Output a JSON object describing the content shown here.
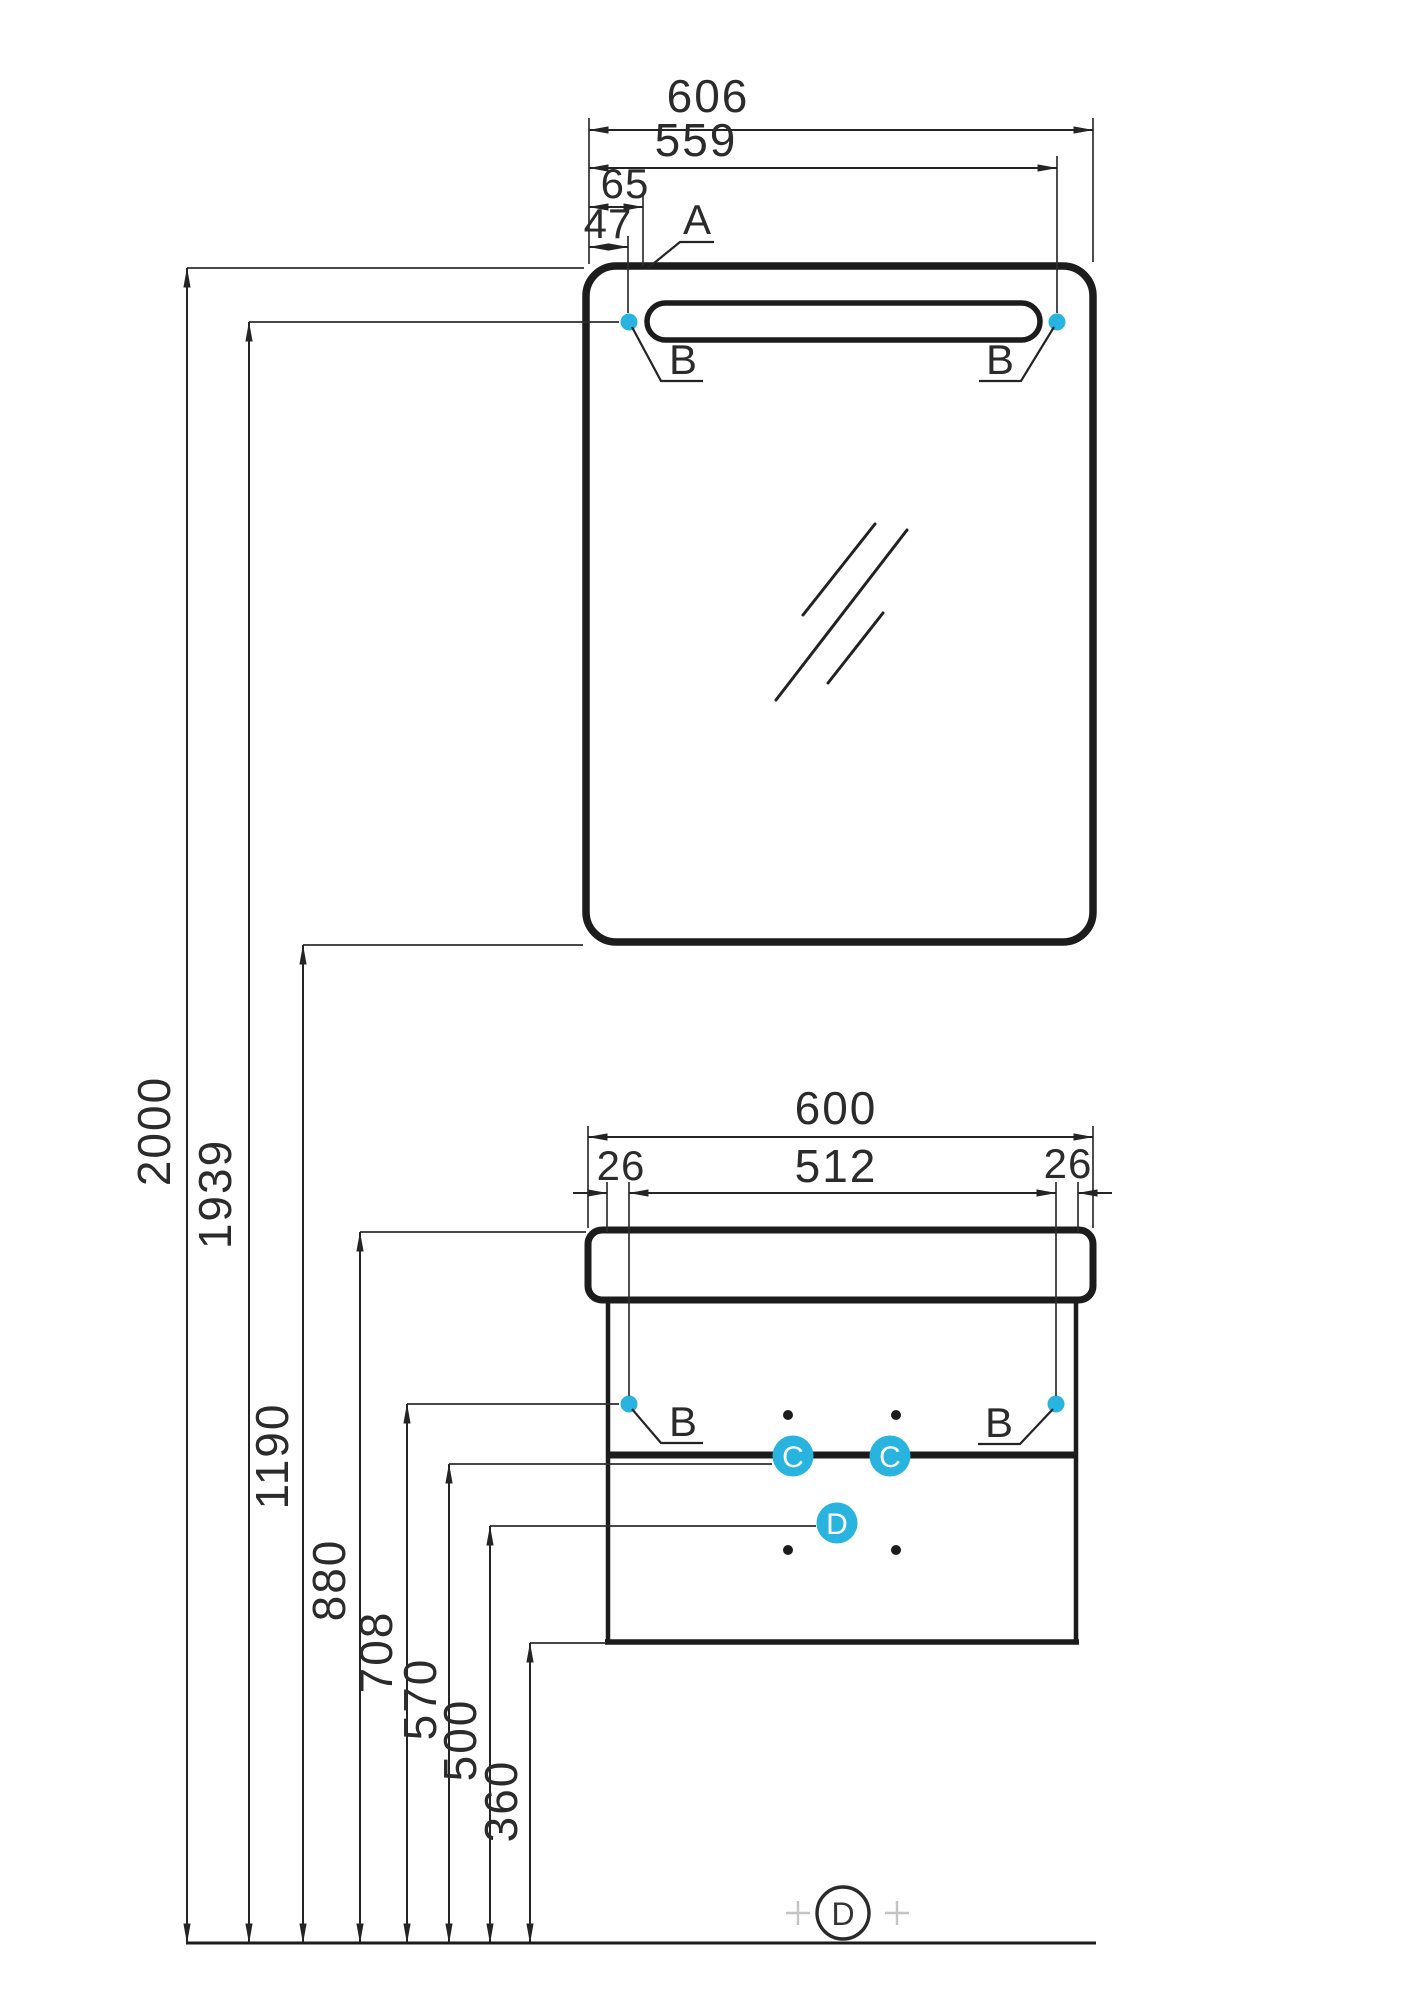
{
  "drawing": {
    "type": "installation-dimension-drawing",
    "units": "mm",
    "colors": {
      "accent_cyan": "#29b4e0",
      "line": "#1c1c1c",
      "dim_text": "#2b2b2b",
      "crosshair_gray": "#c4c4c4"
    },
    "horizontal_dimensions": {
      "mirror_overall_width": "606",
      "mirror_right_fixing_offset": "559",
      "mirror_detail_offset": "65",
      "mirror_left_fixing_offset": "47",
      "cabinet_overall_width": "600",
      "cabinet_fixing_span": "512",
      "cabinet_fixing_offset_left": "26",
      "cabinet_fixing_offset_right": "26"
    },
    "vertical_dimensions": {
      "overall_height": "2000",
      "mirror_fixing_height": "1939",
      "mirror_bottom_height": "1190",
      "cabinet_top_height": "880",
      "cabinet_fixing_height": "708",
      "drawer_divider_height": "570",
      "point_d_height": "500",
      "cabinet_bottom_height": "360"
    },
    "callouts": {
      "a": "A",
      "b": "B",
      "c": "C",
      "d": "D"
    }
  }
}
